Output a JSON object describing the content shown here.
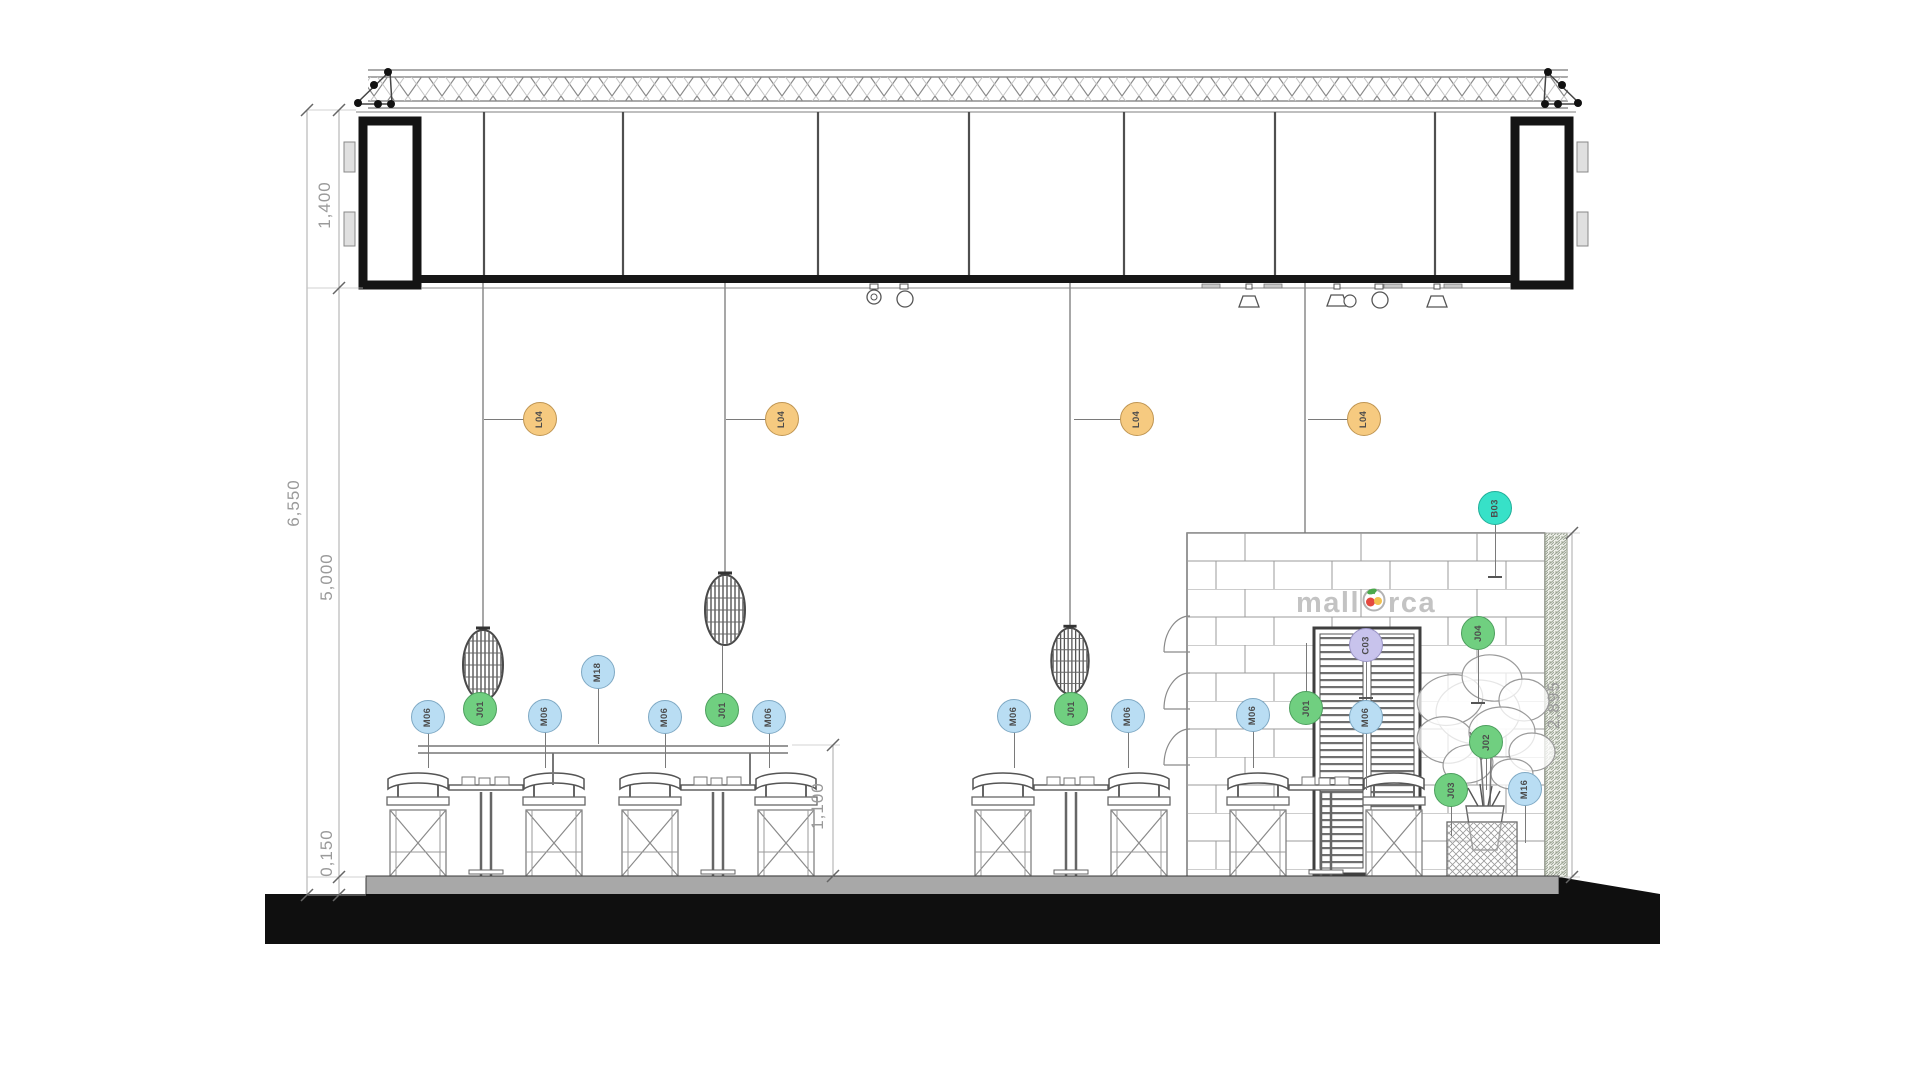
{
  "sign": {
    "pre": "mall",
    "post": "rca",
    "full": "mallorca"
  },
  "dimensions": [
    {
      "label": "1,400",
      "x": 325,
      "y": 205
    },
    {
      "label": "6,550",
      "x": 294,
      "y": 503
    },
    {
      "label": "5,000",
      "x": 327,
      "y": 577
    },
    {
      "label": "0,150",
      "x": 327,
      "y": 853
    },
    {
      "label": "1,100",
      "x": 818,
      "y": 806
    },
    {
      "label": "2,895",
      "x": 1554,
      "y": 705
    }
  ],
  "tag_colors": {
    "orange": {
      "fill": "#f6ca80",
      "stroke": "#bf9552"
    },
    "green": {
      "fill": "#70cf80",
      "stroke": "#4d9f5e"
    },
    "blue": {
      "fill": "#b9ddf3",
      "stroke": "#7fa9c4"
    },
    "teal": {
      "fill": "#37e1c8",
      "stroke": "#21af99"
    },
    "purple": {
      "fill": "#c8c3ec",
      "stroke": "#9a94c6"
    }
  },
  "tags": [
    {
      "label": "L04",
      "color": "orange",
      "x": 540,
      "y": 419
    },
    {
      "label": "L04",
      "color": "orange",
      "x": 782,
      "y": 419
    },
    {
      "label": "L04",
      "color": "orange",
      "x": 1137,
      "y": 419
    },
    {
      "label": "L04",
      "color": "orange",
      "x": 1364,
      "y": 419
    },
    {
      "label": "J01",
      "color": "green",
      "x": 480,
      "y": 709
    },
    {
      "label": "J01",
      "color": "green",
      "x": 722,
      "y": 710
    },
    {
      "label": "J01",
      "color": "green",
      "x": 1071,
      "y": 709
    },
    {
      "label": "J01",
      "color": "green",
      "x": 1306,
      "y": 708
    },
    {
      "label": "M06",
      "color": "blue",
      "x": 428,
      "y": 717
    },
    {
      "label": "M06",
      "color": "blue",
      "x": 545,
      "y": 716
    },
    {
      "label": "M06",
      "color": "blue",
      "x": 665,
      "y": 717
    },
    {
      "label": "M06",
      "color": "blue",
      "x": 769,
      "y": 717
    },
    {
      "label": "M06",
      "color": "blue",
      "x": 1014,
      "y": 716
    },
    {
      "label": "M06",
      "color": "blue",
      "x": 1128,
      "y": 716
    },
    {
      "label": "M06",
      "color": "blue",
      "x": 1253,
      "y": 715
    },
    {
      "label": "M06",
      "color": "blue",
      "x": 1366,
      "y": 717
    },
    {
      "label": "M18",
      "color": "blue",
      "x": 598,
      "y": 672
    },
    {
      "label": "M16",
      "color": "blue",
      "x": 1525,
      "y": 789
    },
    {
      "label": "C03",
      "color": "purple",
      "x": 1366,
      "y": 645
    },
    {
      "label": "B03",
      "color": "teal",
      "x": 1495,
      "y": 508
    },
    {
      "label": "J04",
      "color": "green",
      "x": 1478,
      "y": 633
    },
    {
      "label": "J02",
      "color": "green",
      "x": 1486,
      "y": 742
    },
    {
      "label": "J03",
      "color": "green",
      "x": 1451,
      "y": 790
    }
  ],
  "leaders": [
    [
      524,
      419,
      484,
      419
    ],
    [
      766,
      419,
      726,
      419
    ],
    [
      1121,
      419,
      1074,
      419
    ],
    [
      1348,
      419,
      1308,
      419
    ],
    [
      480,
      693,
      480,
      700
    ],
    [
      722,
      694,
      722,
      646
    ],
    [
      1071,
      693,
      1071,
      697
    ],
    [
      1306,
      692,
      1306,
      643
    ],
    [
      428,
      733,
      428,
      768
    ],
    [
      545,
      732,
      545,
      768
    ],
    [
      665,
      733,
      665,
      768
    ],
    [
      769,
      733,
      769,
      768
    ],
    [
      1014,
      732,
      1014,
      768
    ],
    [
      1128,
      732,
      1128,
      768
    ],
    [
      1253,
      731,
      1253,
      768
    ],
    [
      1366,
      733,
      1366,
      790
    ],
    [
      598,
      688,
      598,
      744
    ],
    [
      1525,
      805,
      1525,
      843
    ],
    [
      1366,
      661,
      1366,
      701
    ],
    [
      1495,
      524,
      1495,
      577
    ],
    [
      1478,
      649,
      1478,
      703
    ],
    [
      1486,
      758,
      1486,
      790
    ],
    [
      1451,
      806,
      1451,
      836
    ]
  ],
  "leader_ticks": [
    [
      1495,
      577
    ],
    [
      1478,
      703
    ],
    [
      1366,
      698
    ]
  ]
}
